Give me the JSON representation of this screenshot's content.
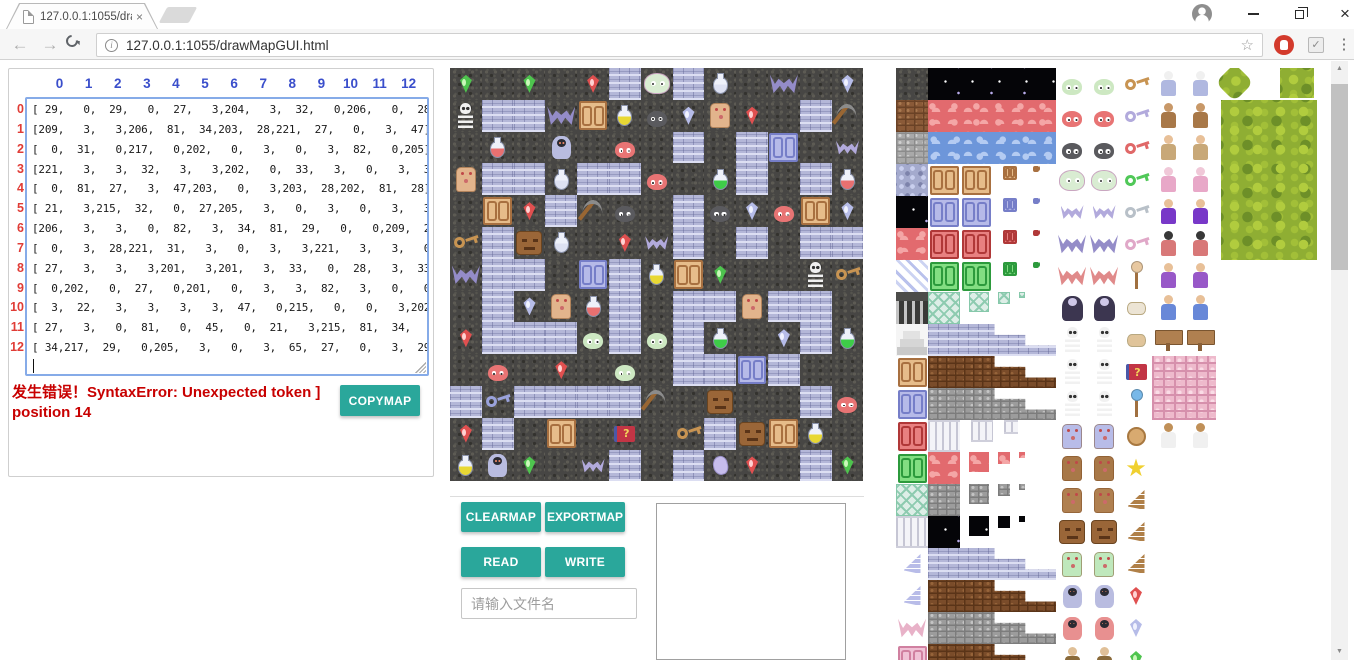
{
  "colors": {
    "accent": "#2aa79b",
    "error": "#c80000",
    "colhdr": "#3a4ecb",
    "rowhdr": "#e03c36"
  },
  "browser": {
    "tab_title": "127.0.0.1:1055/drawMa",
    "tab_close": "×",
    "url": "127.0.0.1:1055/drawMapGUI.html",
    "info_glyph": "i",
    "star_glyph": "☆",
    "menu_glyph": "⋮",
    "ext_check_glyph": "✓",
    "window_close_glyph": "×",
    "scroll_up_glyph": "▲",
    "scroll_down_glyph": "▼"
  },
  "matrix": {
    "col_headers": [
      "0",
      "1",
      "2",
      "3",
      "4",
      "5",
      "6",
      "7",
      "8",
      "9",
      "10",
      "11",
      "12"
    ],
    "row_headers": [
      "0",
      "1",
      "2",
      "3",
      "4",
      "5",
      "6",
      "7",
      "8",
      "9",
      "10",
      "11",
      "12"
    ],
    "lines": [
      "[ 29,   0,  29,   0,  27,   3,204,   3,  32,   0,206,   0,  28],",
      "[209,   3,   3,206,  81,  34,203,  28,221,  27,   0,   3,  47],",
      "[  0,  31,   0,217,   0,202,   0,   3,   0,   3,  82,   0,205],",
      "[221,   3,   3,  32,   3,   3,202,   0,  33,   3,   0,   3,  31],",
      "[  0,  81,  27,   3,  47,203,   0,   3,203,  28,202,  81,  28],",
      "[ 21,   3,215,  32,   0,  27,205,   3,   0,   3,   0,   3,   3],",
      "[206,   3,   3,   0,  82,   3,  34,  81,  29,   0,   0,209,  21],",
      "[  0,   3,  28,221,  31,   3,   0,   3,   3,221,   3,   3,   0],",
      "[ 27,   3,   3,   3,201,   3,201,   3,  33,   0,  28,   3,  33],",
      "[  0,202,   0,  27,   0,201,   0,   3,   3,  82,   3,   0,   0],",
      "[  3,  22,   3,   3,   3,   3,  47,   0,215,   0,   0,   3,202],",
      "[ 27,   3,   0,  81,   0,  45,   0,  21,   3,215,  81,  34,   0],",
      "[ 34,217,  29,   0,205,   3,   0,   3,  65,  27,   0,   3,  29]"
    ]
  },
  "error_text": "发生错误！SyntaxError: Unexpected token ] position 14",
  "buttons": {
    "copymap": "COPYMAP",
    "clearmap": "CLEARMAP",
    "exportmap": "EXPORTMAP",
    "read": "READ",
    "write": "WRITE"
  },
  "file_input": {
    "placeholder": "请输入文件名"
  },
  "map": {
    "grid": [
      [
        29,
        0,
        29,
        0,
        27,
        3,
        204,
        3,
        32,
        0,
        206,
        0,
        28
      ],
      [
        209,
        3,
        3,
        206,
        81,
        34,
        203,
        28,
        221,
        27,
        0,
        3,
        47
      ],
      [
        0,
        31,
        0,
        217,
        0,
        202,
        0,
        3,
        0,
        3,
        82,
        0,
        205
      ],
      [
        221,
        3,
        3,
        32,
        3,
        3,
        202,
        0,
        33,
        3,
        0,
        3,
        31
      ],
      [
        0,
        81,
        27,
        3,
        47,
        203,
        0,
        3,
        203,
        28,
        202,
        81,
        28
      ],
      [
        21,
        3,
        215,
        32,
        0,
        27,
        205,
        3,
        0,
        3,
        0,
        3,
        3
      ],
      [
        206,
        3,
        3,
        0,
        82,
        3,
        34,
        81,
        29,
        0,
        0,
        209,
        21
      ],
      [
        0,
        3,
        28,
        221,
        31,
        3,
        0,
        3,
        3,
        221,
        3,
        3,
        0
      ],
      [
        27,
        3,
        3,
        3,
        201,
        3,
        201,
        3,
        33,
        0,
        28,
        3,
        33
      ],
      [
        0,
        202,
        0,
        27,
        0,
        201,
        0,
        3,
        3,
        82,
        3,
        0,
        0
      ],
      [
        3,
        22,
        3,
        3,
        3,
        3,
        47,
        0,
        215,
        0,
        0,
        3,
        202
      ],
      [
        27,
        3,
        0,
        81,
        0,
        45,
        0,
        21,
        3,
        215,
        81,
        34,
        0
      ],
      [
        34,
        217,
        29,
        0,
        205,
        3,
        0,
        3,
        65,
        27,
        0,
        3,
        29
      ]
    ]
  },
  "tile_defs": {
    "0": {
      "name": "floor",
      "bg": "floor"
    },
    "3": {
      "name": "wall",
      "bg": "wall"
    },
    "21": {
      "name": "yellow-key",
      "bg": "floor",
      "shape": "key",
      "c1": "#c89452"
    },
    "22": {
      "name": "blue-key",
      "bg": "floor",
      "shape": "key",
      "c1": "#9aa2dc"
    },
    "27": {
      "name": "red-gem",
      "bg": "floor",
      "shape": "gem",
      "c1": "#e05050",
      "c2": "#ffd2d2"
    },
    "28": {
      "name": "blue-gem",
      "bg": "floor",
      "shape": "gem",
      "c1": "#b6bce8",
      "c2": "#f0f2ff"
    },
    "29": {
      "name": "green-gem",
      "bg": "floor",
      "shape": "gem",
      "c1": "#4ec44e",
      "c2": "#caf8ba"
    },
    "31": {
      "name": "red-potion",
      "bg": "floor",
      "shape": "potion",
      "c1": "#e87070"
    },
    "32": {
      "name": "silver-potion",
      "bg": "floor",
      "shape": "potion",
      "c1": "#dde1f2"
    },
    "33": {
      "name": "green-potion",
      "bg": "floor",
      "shape": "potion",
      "c1": "#3ecc48"
    },
    "34": {
      "name": "yellow-potion",
      "bg": "floor",
      "shape": "potion",
      "c1": "#e8d834"
    },
    "45": {
      "name": "magic-book",
      "bg": "floor",
      "shape": "book",
      "c1": "#c23545",
      "c2": "#4a58a8",
      "glyph": "?"
    },
    "47": {
      "name": "pickaxe",
      "bg": "floor",
      "shape": "pick"
    },
    "65": {
      "name": "conch",
      "bg": "floor",
      "shape": "conch",
      "c1": "#c6bcec"
    },
    "81": {
      "name": "tan-door",
      "bg": "floor",
      "shape": "door",
      "c1": "#e6bc8a",
      "c2": "#a87040"
    },
    "82": {
      "name": "blue-door",
      "bg": "floor",
      "shape": "door",
      "c1": "#b6bae8",
      "c2": "#767ec8"
    },
    "201": {
      "name": "green-slime",
      "bg": "floor",
      "shape": "slime",
      "c1": "#cde8c2"
    },
    "202": {
      "name": "red-slime",
      "bg": "floor",
      "shape": "slime",
      "c1": "#e87474"
    },
    "203": {
      "name": "black-slime",
      "bg": "floor",
      "shape": "slime",
      "c1": "#5a5a5e"
    },
    "204": {
      "name": "big-slime",
      "bg": "floor",
      "shape": "bigslime",
      "c1": "#d9ecd2"
    },
    "205": {
      "name": "small-bat",
      "bg": "floor",
      "shape": "bat",
      "c1": "#b2aadc"
    },
    "206": {
      "name": "big-bat",
      "bg": "floor",
      "shape": "batbig",
      "c1": "#948cc8"
    },
    "209": {
      "name": "skeleton",
      "bg": "floor",
      "shape": "skel"
    },
    "215": {
      "name": "stone-face",
      "bg": "floor",
      "shape": "face",
      "c1": "#9a6638"
    },
    "217": {
      "name": "ghost",
      "bg": "floor",
      "shape": "ghost",
      "c1": "#b9bce0"
    },
    "221": {
      "name": "golem",
      "bg": "floor",
      "shape": "golem",
      "c1": "#e2b48c"
    },
    "brickBr": {
      "name": "brown-brick",
      "bg": "brickBr"
    },
    "brickGr": {
      "name": "gray-brick",
      "bg": "brickGr"
    },
    "stoneB": {
      "name": "blue-stone",
      "bg": "stoneB"
    },
    "night": {
      "name": "night-sky",
      "bg": "night"
    },
    "lava": {
      "name": "lava",
      "bg": "lava"
    },
    "water": {
      "name": "water",
      "bg": "water"
    },
    "stripe": {
      "name": "ice-stripe",
      "bg": "stripe"
    },
    "grate": {
      "name": "grate",
      "bg": "grate"
    },
    "stairs": {
      "name": "stairs",
      "bg": "stairs"
    },
    "lattice": {
      "name": "lattice",
      "bg": "lattice"
    },
    "column": {
      "name": "column",
      "bg": "column"
    },
    "wall": {
      "name": "blue-wall",
      "bg": "wall"
    },
    "wallBr": {
      "name": "brown-wall",
      "bg": "wallBr"
    },
    "wallGr": {
      "name": "gray-wall",
      "bg": "wallGr"
    },
    "wallP": {
      "name": "pink-wall",
      "bg": "wallP"
    },
    "doorT": {
      "name": "tan-door",
      "shape": "door",
      "c1": "#e6bc8a",
      "c2": "#a87040"
    },
    "doorB": {
      "name": "blue-door",
      "shape": "door",
      "c1": "#b6bae8",
      "c2": "#767ec8"
    },
    "doorR": {
      "name": "red-door",
      "shape": "door",
      "c1": "#e88080",
      "c2": "#b03838"
    },
    "doorG": {
      "name": "green-door",
      "shape": "door",
      "c1": "#82de82",
      "c2": "#2c9a3c"
    },
    "doorP": {
      "name": "pink-door",
      "shape": "door",
      "c1": "#f0c2d6",
      "c2": "#d080a0"
    },
    "batR": {
      "name": "red-bat",
      "shape": "batbig",
      "c1": "#e08a8a"
    },
    "batP": {
      "name": "pink-bat",
      "shape": "batbig",
      "c1": "#e8b2c8"
    },
    "vamp": {
      "name": "vampire",
      "shape": "vamp"
    },
    "skelW": {
      "name": "skeleton-warrior",
      "shape": "skel"
    },
    "skelC": {
      "name": "skeleton-captain",
      "shape": "skel"
    },
    "knight": {
      "name": "blue-knight",
      "shape": "golem",
      "c1": "#b8bce8"
    },
    "golemBr": {
      "name": "brown-golem",
      "shape": "golem",
      "c1": "#a87848"
    },
    "golemW": {
      "name": "golem-warrior",
      "shape": "golem",
      "c1": "#b08050"
    },
    "zomb": {
      "name": "green-zombie",
      "shape": "golem",
      "c1": "#bfe8bc"
    },
    "ghostR": {
      "name": "red-ghost",
      "shape": "ghost",
      "c1": "#e89090"
    },
    "hatman": {
      "name": "hat-man",
      "shape": "person",
      "c1": "#8a6a3a",
      "c2": "#e0c098"
    },
    "keyY": {
      "name": "yellow-key",
      "shape": "key",
      "c1": "#c89452"
    },
    "keyL": {
      "name": "lavender-key",
      "shape": "key",
      "c1": "#b2aadc"
    },
    "keyR": {
      "name": "red-key",
      "shape": "key",
      "c1": "#e06868"
    },
    "keyG": {
      "name": "green-key",
      "shape": "key",
      "c1": "#50c858"
    },
    "keyGr": {
      "name": "gray-key",
      "shape": "key",
      "c1": "#b8c0c8"
    },
    "keyP": {
      "name": "pink-key",
      "shape": "key",
      "c1": "#e0a8c8"
    },
    "wingL": {
      "name": "lavender-wing",
      "shape": "wing",
      "c1": "#b8bce8"
    },
    "wing": {
      "name": "brown-wing",
      "shape": "wing",
      "c1": "#b08048"
    },
    "wingF": {
      "name": "flag-wing",
      "shape": "wing",
      "c1": "#b08048"
    },
    "staff": {
      "name": "staff",
      "shape": "staff",
      "c1": "#e8c8a0"
    },
    "staff2": {
      "name": "orb-staff",
      "shape": "staff",
      "c1": "#78b8e8"
    },
    "scrollR": {
      "name": "red-scroll",
      "shape": "scroll",
      "c1": "#ece4d4"
    },
    "scrollT": {
      "name": "tan-scroll",
      "shape": "scroll",
      "c1": "#e0c49a"
    },
    "medal": {
      "name": "medal",
      "shape": "medal",
      "c1": "#d8aa70"
    },
    "starY": {
      "name": "yellow-star",
      "shape": "star",
      "c1": "#f0d030",
      "glyph": "★"
    },
    "oldman": {
      "name": "old-wizard",
      "shape": "person",
      "c1": "#b0b8e0",
      "c2": "#f0f0f0"
    },
    "monk": {
      "name": "brown-monk",
      "shape": "person",
      "c1": "#a87848",
      "c2": "#c89868"
    },
    "fighter": {
      "name": "fighter",
      "shape": "person",
      "c1": "#c8a878",
      "c2": "#e8c098"
    },
    "fairy": {
      "name": "fairy",
      "shape": "person",
      "c1": "#e8a8c8",
      "c2": "#f0c8d8"
    },
    "wizardP": {
      "name": "purple-wizard",
      "shape": "person",
      "c1": "#7838c8",
      "c2": "#e8c098"
    },
    "hoodR": {
      "name": "red-hood",
      "shape": "person",
      "c1": "#d87878",
      "c2": "#383838"
    },
    "prince": {
      "name": "prince",
      "shape": "person",
      "c1": "#9858c8",
      "c2": "#e8c098"
    },
    "boyB": {
      "name": "blue-boy",
      "shape": "person",
      "c1": "#6888d8",
      "c2": "#e8c098"
    },
    "sign": {
      "name": "wood-sign",
      "shape": "sign"
    },
    "princess": {
      "name": "princess",
      "shape": "person",
      "c1": "#f0f0f0",
      "c2": "#c09058"
    }
  },
  "palette": {
    "strip": [
      "0",
      "brickBr",
      "brickGr",
      "stoneB",
      "night",
      "lava",
      "stripe",
      "grate",
      "stairs",
      "doorT",
      "doorB",
      "doorR",
      "doorG",
      "lattice",
      "column",
      "wingL",
      "wingL",
      "batP",
      "doorP"
    ],
    "rows": [
      {
        "band": [
          "flat",
          "night"
        ],
        "monster": "201",
        "item": "keyY",
        "chars": "oldman"
      },
      {
        "band": [
          "flat",
          "lava"
        ],
        "monster": "202",
        "item": "keyL",
        "chars": "monk"
      },
      {
        "band": [
          "flat",
          "water"
        ],
        "monster": "203",
        "item": "keyR",
        "chars": "fighter"
      },
      {
        "band": [
          "doors",
          "doorT"
        ],
        "monster": "204",
        "item": "keyG",
        "chars": "fairy"
      },
      {
        "band": [
          "doors",
          "doorB"
        ],
        "monster": "205",
        "item": "keyGr",
        "chars": "wizardP"
      },
      {
        "band": [
          "doors",
          "doorR"
        ],
        "monster": "206",
        "item": "keyP",
        "chars": "hoodR"
      },
      {
        "band": [
          "doors",
          "doorG"
        ],
        "monster": "batR",
        "item": "staff",
        "chars": "prince"
      },
      {
        "band": [
          "shrink",
          "lattice"
        ],
        "monster": "vamp",
        "item": "scrollR",
        "chars": "boyB"
      },
      {
        "band": [
          "steps",
          "wall"
        ],
        "monster": "209",
        "item": "scrollT",
        "chars": "sign"
      },
      {
        "band": [
          "steps",
          "wallBr"
        ],
        "monster": "skelW",
        "item": "45",
        "chars": "wallP"
      },
      {
        "band": [
          "steps",
          "wallGr"
        ],
        "monster": "skelC",
        "item": "staff2",
        "chars": "wallP"
      },
      {
        "band": [
          "cols",
          "column"
        ],
        "monster": "knight",
        "item": "medal",
        "chars": "princess"
      },
      {
        "band": [
          "shrink",
          "lava"
        ],
        "monster": "golemBr",
        "item": "starY",
        "chars": ""
      },
      {
        "band": [
          "shrink",
          "wallGr"
        ],
        "monster": "golemW",
        "item": "wing",
        "chars": ""
      },
      {
        "band": [
          "shrink",
          "night"
        ],
        "monster": "215",
        "item": "wing",
        "chars": ""
      },
      {
        "band": [
          "steps",
          "wall"
        ],
        "monster": "zomb",
        "item": "wingF",
        "chars": ""
      },
      {
        "band": [
          "steps",
          "wallBr"
        ],
        "monster": "217",
        "item": "27",
        "chars": ""
      },
      {
        "band": [
          "steps",
          "wallGr"
        ],
        "monster": "ghostR",
        "item": "28",
        "chars": ""
      },
      {
        "band": [
          "steps",
          "wallBr"
        ],
        "monster": "hatman",
        "item": "29",
        "chars": ""
      }
    ]
  }
}
